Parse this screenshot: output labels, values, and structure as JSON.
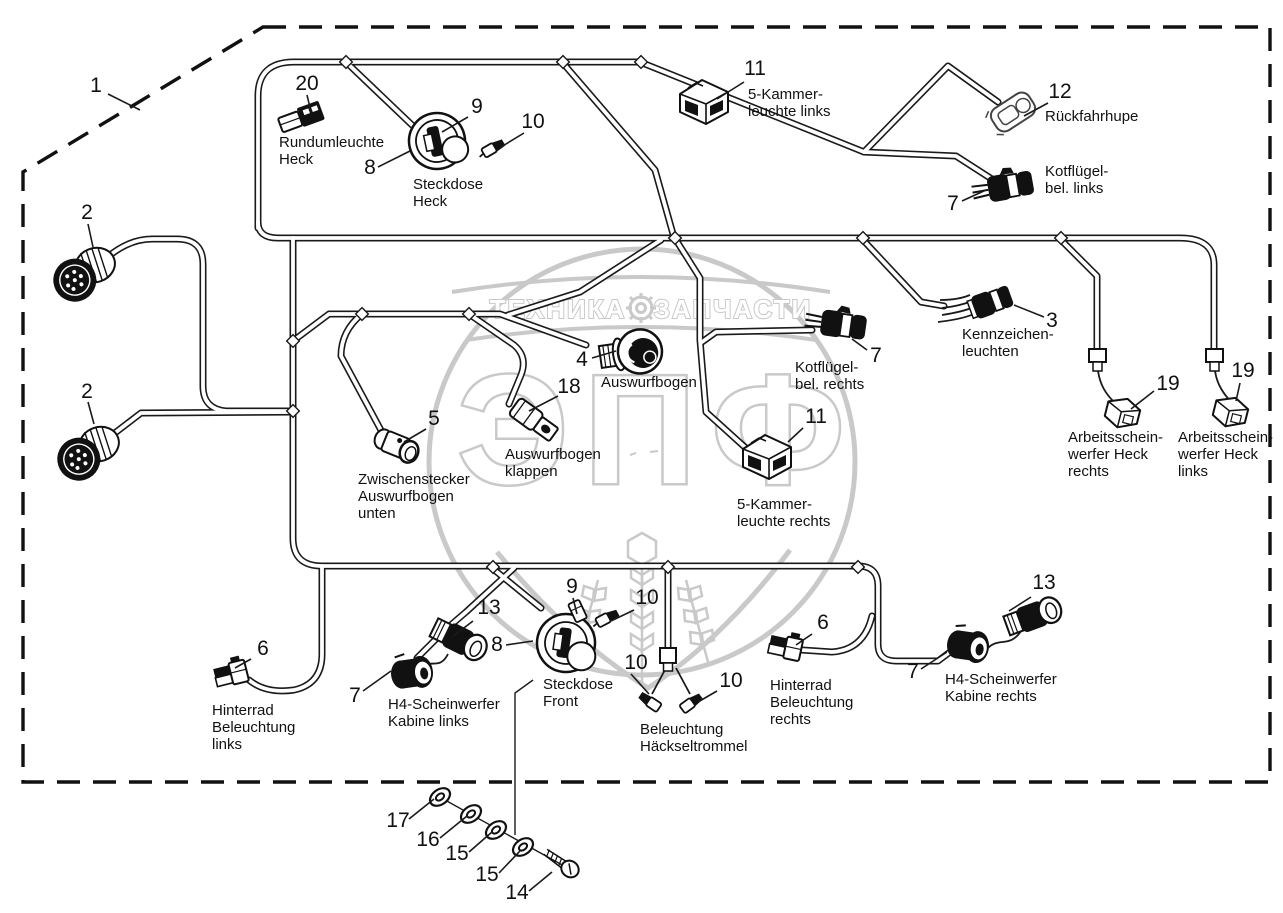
{
  "colors": {
    "line": "#1a1a1a",
    "watermark": "#c9c9c9"
  },
  "watermark": {
    "top_left": "ТЕХНИКА",
    "top_right": "ЗАПЧАСТИ",
    "letter1": "Э",
    "letter2": "П",
    "letter3": "Ф"
  },
  "callouts": {
    "boundary": {
      "num": "1"
    },
    "rundumleuchte": {
      "num": "20",
      "lines": [
        "Rundumleuchte",
        "Heck"
      ]
    },
    "steckdose_heck": {
      "num": "8",
      "insert_num": "9",
      "terminal_num": "10",
      "lines": [
        "Steckdose",
        "Heck"
      ]
    },
    "kammer_links": {
      "num": "11",
      "lines": [
        "5-Kammer-",
        "leuchte links"
      ]
    },
    "rueckfahrhupe": {
      "num": "12",
      "lines": [
        "Rückfahrhupe"
      ]
    },
    "kotfluegel_links": {
      "num": "7",
      "lines": [
        "Kotflügel-",
        "bel. links"
      ]
    },
    "stecker_oben": {
      "num": "2"
    },
    "stecker_unten": {
      "num": "2"
    },
    "kennzeichen": {
      "num": "3",
      "lines": [
        "Kennzeichen-",
        "leuchten"
      ]
    },
    "kotfluegel_rechts": {
      "num": "7",
      "lines": [
        "Kotflügel-",
        "bel. rechts"
      ]
    },
    "arbeitsscheinwerfer_rechts": {
      "num": "19",
      "lines": [
        "Arbeitsschein-",
        "werfer Heck",
        "rechts"
      ]
    },
    "arbeitsscheinwerfer_links": {
      "num": "19",
      "lines": [
        "Arbeitsschein-",
        "werfer Heck",
        "links"
      ]
    },
    "auswurfbogen": {
      "num": "4",
      "lines": [
        "Auswurfbogen"
      ]
    },
    "auswurfbogen_klappen": {
      "num": "18",
      "lines": [
        "Auswurfbogen",
        "klappen"
      ]
    },
    "zwischenstecker": {
      "num": "5",
      "lines": [
        "Zwischenstecker",
        "Auswurfbogen",
        "unten"
      ]
    },
    "kammer_rechts": {
      "num": "11",
      "lines": [
        "5-Kammer-",
        "leuchte rechts"
      ]
    },
    "hinterrad_links": {
      "num": "6",
      "lines": [
        "Hinterrad",
        "Beleuchtung",
        "links"
      ]
    },
    "h4_links": {
      "num7": "7",
      "num13": "13",
      "lines": [
        "H4-Scheinwerfer",
        "Kabine links"
      ]
    },
    "steckdose_front": {
      "num": "8",
      "insert_num": "9",
      "terminal_num": "10",
      "lines": [
        "Steckdose",
        "Front"
      ]
    },
    "haeckseltrommel": {
      "num_left": "10",
      "num_right": "10",
      "lines": [
        "Beleuchtung",
        "Häckseltrommel"
      ]
    },
    "hinterrad_rechts": {
      "num": "6",
      "lines": [
        "Hinterrad",
        "Beleuchtung",
        "rechts"
      ]
    },
    "h4_rechts": {
      "num7": "7",
      "num13": "13",
      "lines": [
        "H4-Scheinwerfer",
        "Kabine rechts"
      ]
    },
    "hardware": {
      "nut": "17",
      "washer_a": "16",
      "washer_b": "15",
      "washer_c": "15",
      "screw": "14"
    }
  }
}
